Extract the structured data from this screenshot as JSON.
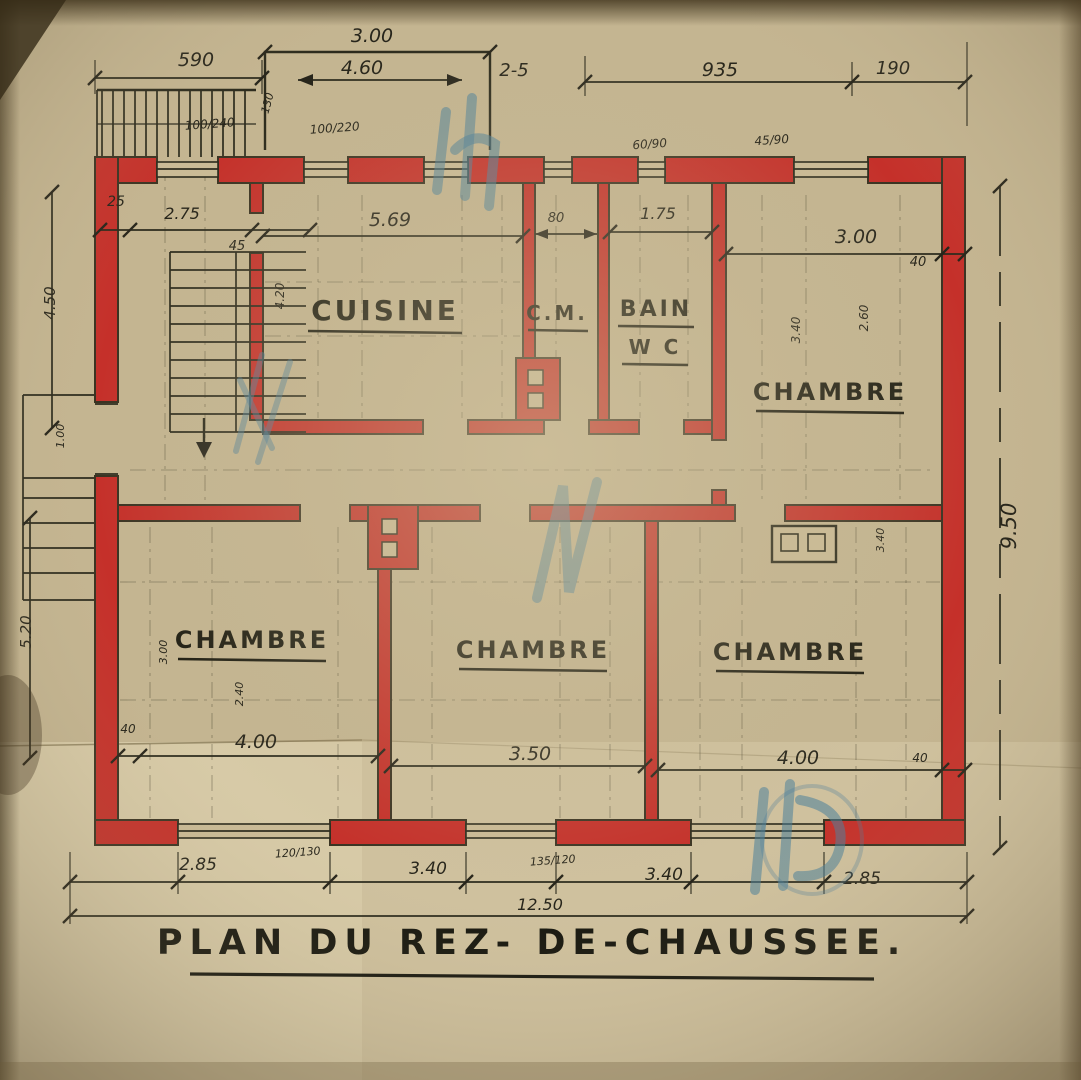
{
  "colors": {
    "paper": "#c4b591",
    "wall_red": "#c5302a",
    "ink": "#2b2a1c",
    "pencil_blue": "#4b7f9b"
  },
  "title": {
    "text": "PLAN DU REZ- DE-CHAUSSEE."
  },
  "rooms": [
    {
      "name": "CUISINE"
    },
    {
      "name": "C.M."
    },
    {
      "name": "BAIN"
    },
    {
      "name": "W C"
    },
    {
      "name": "CHAMBRE"
    },
    {
      "name": "CHAMBRE"
    },
    {
      "name": "CHAMBRE"
    },
    {
      "name": "CHAMBRE"
    }
  ],
  "dims": [
    {
      "t": "3.00"
    },
    {
      "t": "590"
    },
    {
      "t": "4.60"
    },
    {
      "t": "2-5"
    },
    {
      "t": "935"
    },
    {
      "t": "190"
    },
    {
      "t": "100/240"
    },
    {
      "t": "100/220"
    },
    {
      "t": "130"
    },
    {
      "t": "60/90"
    },
    {
      "t": "45/90"
    },
    {
      "t": "25"
    },
    {
      "t": "2.75"
    },
    {
      "t": "45"
    },
    {
      "t": "5.69"
    },
    {
      "t": "80"
    },
    {
      "t": "1.75"
    },
    {
      "t": "3.00"
    },
    {
      "t": "40"
    },
    {
      "t": "4.50"
    },
    {
      "t": "5.20"
    },
    {
      "t": "9.50"
    },
    {
      "t": "4.20"
    },
    {
      "t": "3.40"
    },
    {
      "t": "2.60"
    },
    {
      "t": "4.00"
    },
    {
      "t": "40"
    },
    {
      "t": "3.50"
    },
    {
      "t": "4.00"
    },
    {
      "t": "40"
    },
    {
      "t": "2.85"
    },
    {
      "t": "120/130"
    },
    {
      "t": "3.40"
    },
    {
      "t": "135/120"
    },
    {
      "t": "3.40"
    },
    {
      "t": "2.85"
    },
    {
      "t": "12.50"
    },
    {
      "t": "1.00"
    },
    {
      "t": "2.40"
    },
    {
      "t": "3.00"
    },
    {
      "t": "3.40"
    }
  ]
}
